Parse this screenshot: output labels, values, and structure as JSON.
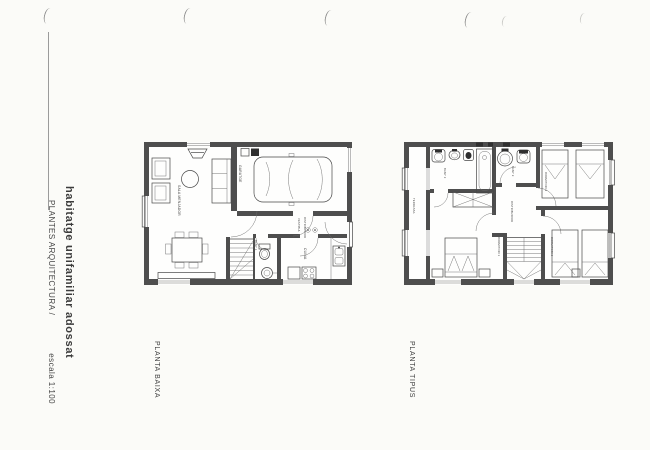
{
  "sheet": {
    "project_title": "habitatge unifamiliar adossat",
    "discipline": "PLANTES ARQUITECTURA /",
    "scale_note": "escala 1:100"
  },
  "ground_floor": {
    "title": "PLANTA BAIXA",
    "rooms": {
      "living": "SALA MENJADOR",
      "garage": "GARATGE",
      "hall_1": "VESTIBUL",
      "hall_2": "DISTRIBUIDOR",
      "bath": "BANY 1",
      "kitchen": "CUINA"
    }
  },
  "upper_floor": {
    "title": "PLANTA TIPUS",
    "rooms": {
      "terrace": "TERRASSA",
      "bath_2": "BANY 2",
      "bath_3": "BANY 3",
      "hall": "DISTRIBUIDOR",
      "bedroom_1": "DORMITORI 1",
      "bedroom_2": "DORMITORI 2",
      "bedroom_3": "DORMITORI 3"
    }
  },
  "colors": {
    "paper": "#fbfbf8",
    "ink": "#464646",
    "wall": "#4e4e4e",
    "faint_marks": "#8e8e8e"
  }
}
